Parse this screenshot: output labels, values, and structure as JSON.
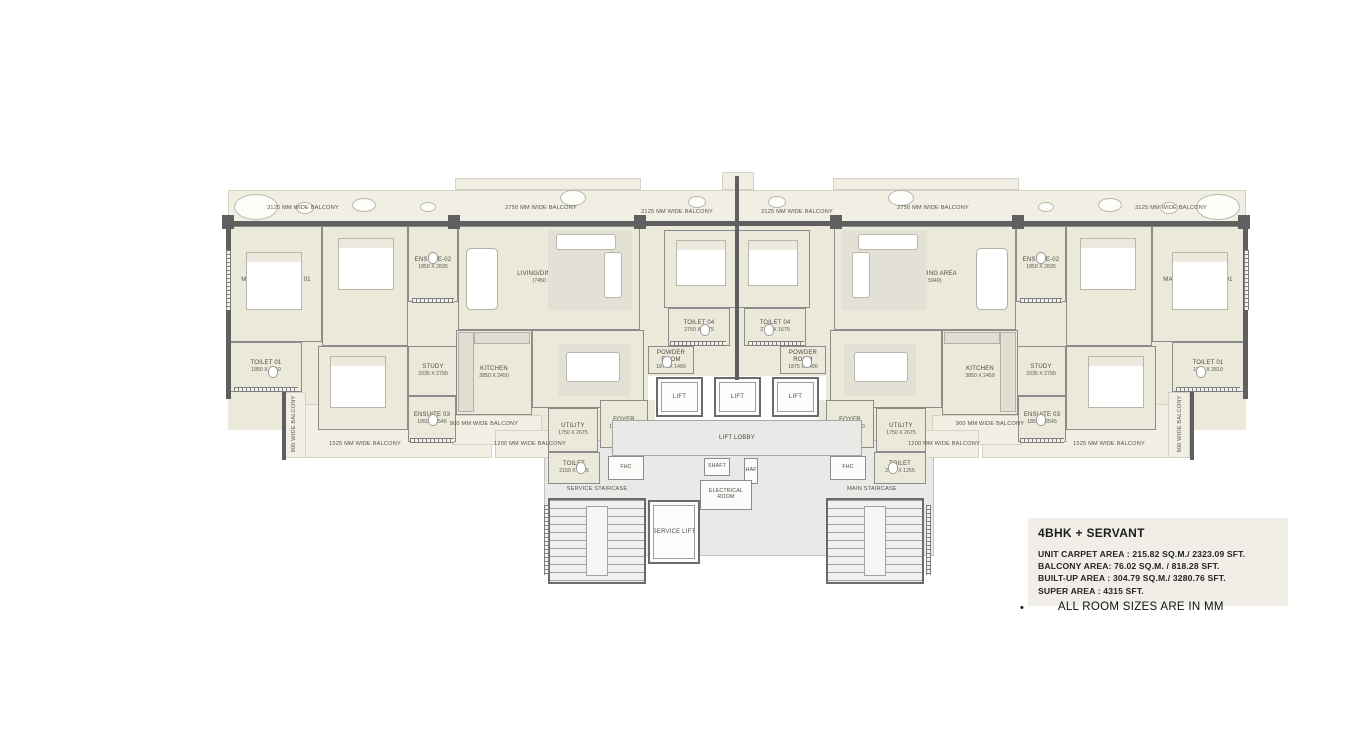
{
  "info": {
    "title": "4BHK + SERVANT",
    "lines": [
      "UNIT CARPET AREA : 215.82  SQ.M./ 2323.09  SFT.",
      "BALCONY AREA: 76.02  SQ.M. / 818.28  SFT.",
      "BUILT-UP AREA : 304.79  SQ.M./ 3280.76 SFT.",
      "SUPER AREA : 4315 SFT."
    ],
    "bullet": "•",
    "note": "ALL ROOM SIZES ARE IN MM"
  },
  "floorplan": {
    "slabs": [
      [
        "bal",
        228,
        190,
        1018,
        36
      ],
      [
        "bal",
        455,
        178,
        186,
        12
      ],
      [
        "bal",
        833,
        178,
        186,
        12
      ],
      [
        "bal",
        722,
        172,
        32,
        18
      ],
      [
        "floor",
        228,
        226,
        420,
        204
      ],
      [
        "floor",
        826,
        226,
        420,
        204
      ],
      [
        "floor",
        640,
        226,
        196,
        150
      ],
      [
        "floor",
        545,
        400,
        110,
        92
      ],
      [
        "floor",
        819,
        400,
        110,
        92
      ],
      [
        "core",
        544,
        440,
        390,
        116
      ],
      [
        "bal",
        288,
        404,
        204,
        54
      ],
      [
        "bal",
        982,
        404,
        204,
        54
      ],
      [
        "bal",
        284,
        392,
        22,
        66
      ],
      [
        "bal",
        1168,
        392,
        22,
        66
      ],
      [
        "bal",
        452,
        415,
        90,
        30
      ],
      [
        "bal",
        932,
        415,
        90,
        30
      ],
      [
        "bal",
        495,
        430,
        80,
        28
      ],
      [
        "bal",
        899,
        430,
        80,
        28
      ]
    ],
    "rooms": [
      {
        "id": "master-bedroom-01-left",
        "n": "MASTER BEDROOM 01",
        "d": "3350 X 5500",
        "x": 230,
        "y": 226,
        "w": 92,
        "h": 116
      },
      {
        "id": "toilet-01-left",
        "n": "TOILET 01",
        "d": "1850 X 2810",
        "x": 230,
        "y": 342,
        "w": 72,
        "h": 50
      },
      {
        "id": "bedroom-02-left",
        "n": "BEDROOM 02",
        "d": "3675 X 4450",
        "x": 322,
        "y": 226,
        "w": 86,
        "h": 120
      },
      {
        "id": "ensuite-02-left",
        "n": "ENSUITE-02",
        "d": "1850 X 2835",
        "x": 408,
        "y": 226,
        "w": 50,
        "h": 76
      },
      {
        "id": "living-dining-left",
        "n": "LIVING/DINING AREA",
        "d": "(7450 X 5940)",
        "x": 458,
        "y": 226,
        "w": 182,
        "h": 104
      },
      {
        "id": "bedroom-04-left",
        "n": "BEDROOM 04",
        "d": "3750 X 4335",
        "x": 664,
        "y": 230,
        "w": 73,
        "h": 78
      },
      {
        "id": "toilet-04-left",
        "n": "TOILET 04",
        "d": "2750 X 1675",
        "x": 668,
        "y": 308,
        "w": 62,
        "h": 38
      },
      {
        "id": "powder-room-left",
        "n": "POWDER ROOM",
        "d": "1875 X 1490",
        "x": 648,
        "y": 346,
        "w": 46,
        "h": 28
      },
      {
        "id": "bedroom-03-left",
        "n": "BEDROOM 03",
        "d": "3675 X 3345",
        "x": 318,
        "y": 346,
        "w": 90,
        "h": 84
      },
      {
        "id": "study-left",
        "n": "STUDY",
        "d": "2035 X 2790",
        "x": 408,
        "y": 346,
        "w": 50,
        "h": 50
      },
      {
        "id": "ensuite-03-left",
        "n": "ENSUITE 03",
        "d": "1850 X 2545",
        "x": 408,
        "y": 396,
        "w": 48,
        "h": 46
      },
      {
        "id": "kitchen-left",
        "n": "KITCHEN",
        "d": "3850 X 2450",
        "x": 456,
        "y": 330,
        "w": 76,
        "h": 85
      },
      {
        "id": "lounge-left",
        "n": "LOUNGE",
        "d": "4550 X 4725",
        "x": 532,
        "y": 330,
        "w": 112,
        "h": 78
      },
      {
        "id": "foyer-left",
        "n": "FOYER",
        "d": "1840 X 2790",
        "x": 600,
        "y": 400,
        "w": 48,
        "h": 48
      },
      {
        "id": "utility-left",
        "n": "UTILITY",
        "d": "1750 X 2675",
        "x": 548,
        "y": 408,
        "w": 50,
        "h": 44
      },
      {
        "id": "toilet-servant-left",
        "n": "TOILET",
        "d": "2150 X 1255",
        "x": 548,
        "y": 452,
        "w": 52,
        "h": 32
      },
      {
        "id": "fhc-left",
        "n": "FHC",
        "d": "",
        "x": 608,
        "y": 456,
        "w": 36,
        "h": 24,
        "k": "core"
      },
      {
        "id": "master-bedroom-01-right",
        "n": "MASTER BEDROOM 01",
        "d": "3350 X 5500",
        "x": 1152,
        "y": 226,
        "w": 92,
        "h": 116
      },
      {
        "id": "toilet-01-right",
        "n": "TOILET 01",
        "d": "1850 X 2810",
        "x": 1172,
        "y": 342,
        "w": 72,
        "h": 50
      },
      {
        "id": "bedroom-02-right",
        "n": "BEDROOM 02",
        "d": "3675 X 4450",
        "x": 1066,
        "y": 226,
        "w": 86,
        "h": 120
      },
      {
        "id": "ensuite-02-right",
        "n": "ENSUITE-02",
        "d": "1850 X 2835",
        "x": 1016,
        "y": 226,
        "w": 50,
        "h": 76
      },
      {
        "id": "living-dining-right",
        "n": "LIVING/DINING AREA",
        "d": "(7450 X 5940)",
        "x": 834,
        "y": 226,
        "w": 182,
        "h": 104
      },
      {
        "id": "bedroom-04-right",
        "n": "BEDROOM 04",
        "d": "3750 X 4335",
        "x": 737,
        "y": 230,
        "w": 73,
        "h": 78
      },
      {
        "id": "toilet-04-right",
        "n": "TOILET 04",
        "d": "2750 X 1675",
        "x": 744,
        "y": 308,
        "w": 62,
        "h": 38
      },
      {
        "id": "powder-room-right",
        "n": "POWDER ROOM",
        "d": "1875 X 1490",
        "x": 780,
        "y": 346,
        "w": 46,
        "h": 28
      },
      {
        "id": "bedroom-03-right",
        "n": "BEDROOM 03",
        "d": "3675 X 3345",
        "x": 1066,
        "y": 346,
        "w": 90,
        "h": 84
      },
      {
        "id": "study-right",
        "n": "STUDY",
        "d": "2035 X 2790",
        "x": 1016,
        "y": 346,
        "w": 50,
        "h": 50
      },
      {
        "id": "ensuite-03-right",
        "n": "ENSUITE 03",
        "d": "1850 X 2545",
        "x": 1018,
        "y": 396,
        "w": 48,
        "h": 46
      },
      {
        "id": "kitchen-right",
        "n": "KITCHEN",
        "d": "3850 X 2450",
        "x": 942,
        "y": 330,
        "w": 76,
        "h": 85
      },
      {
        "id": "lounge-right",
        "n": "LOUNGE",
        "d": "4550 X 4725",
        "x": 830,
        "y": 330,
        "w": 112,
        "h": 78
      },
      {
        "id": "foyer-right",
        "n": "FOYER",
        "d": "1840 X 2790",
        "x": 826,
        "y": 400,
        "w": 48,
        "h": 48
      },
      {
        "id": "utility-right",
        "n": "UTILITY",
        "d": "1750 X 2675",
        "x": 876,
        "y": 408,
        "w": 50,
        "h": 44
      },
      {
        "id": "toilet-servant-right",
        "n": "TOILET",
        "d": "2150 X 1255",
        "x": 874,
        "y": 452,
        "w": 52,
        "h": 32
      },
      {
        "id": "fhc-right",
        "n": "FHC",
        "d": "",
        "x": 830,
        "y": 456,
        "w": 36,
        "h": 24,
        "k": "core"
      },
      {
        "id": "lift-1",
        "n": "LIFT",
        "d": "",
        "x": 656,
        "y": 377,
        "w": 47,
        "h": 40,
        "k": "lift"
      },
      {
        "id": "lift-2",
        "n": "LIFT",
        "d": "",
        "x": 714,
        "y": 377,
        "w": 47,
        "h": 40,
        "k": "lift"
      },
      {
        "id": "lift-3",
        "n": "LIFT",
        "d": "",
        "x": 772,
        "y": 377,
        "w": 47,
        "h": 40,
        "k": "lift"
      },
      {
        "id": "lift-lobby",
        "n": "LIFT LOBBY",
        "d": "",
        "x": 612,
        "y": 420,
        "w": 250,
        "h": 36,
        "k": "lobby"
      },
      {
        "id": "shaft-1",
        "n": "SHAFT",
        "d": "",
        "x": 704,
        "y": 458,
        "w": 26,
        "h": 18,
        "k": "core"
      },
      {
        "id": "shaft-2",
        "n": "SHAFT",
        "d": "",
        "x": 744,
        "y": 458,
        "w": 14,
        "h": 26,
        "k": "core"
      },
      {
        "id": "electrical-room",
        "n": "ELECTRICAL ROOM",
        "d": "",
        "x": 700,
        "y": 480,
        "w": 52,
        "h": 30,
        "k": "core"
      },
      {
        "id": "service-lift",
        "n": "SERVICE LIFT",
        "d": "",
        "x": 648,
        "y": 500,
        "w": 52,
        "h": 64,
        "k": "lift"
      },
      {
        "id": "service-staircase",
        "n": "",
        "d": "",
        "x": 548,
        "y": 498,
        "w": 98,
        "h": 86,
        "k": "stair"
      },
      {
        "id": "main-staircase",
        "n": "",
        "d": "",
        "x": 826,
        "y": 498,
        "w": 98,
        "h": 86,
        "k": "stair"
      }
    ],
    "walls": [
      [
        226,
        221,
        1022,
        5
      ],
      [
        226,
        221,
        5,
        178
      ],
      [
        1243,
        221,
        5,
        178
      ],
      [
        735,
        176,
        4,
        204
      ],
      [
        222,
        215,
        12,
        14
      ],
      [
        448,
        215,
        12,
        14
      ],
      [
        634,
        215,
        12,
        14
      ],
      [
        830,
        215,
        12,
        14
      ],
      [
        1012,
        215,
        12,
        14
      ],
      [
        1238,
        215,
        12,
        14
      ],
      [
        282,
        390,
        4,
        70
      ],
      [
        1190,
        390,
        4,
        70
      ]
    ],
    "windows": [
      [
        "v",
        226,
        250,
        5,
        60
      ],
      [
        "v",
        1244,
        250,
        5,
        60
      ],
      [
        "h",
        412,
        298,
        42,
        5
      ],
      [
        "h",
        1020,
        298,
        42,
        5
      ],
      [
        "h",
        670,
        341,
        56,
        5
      ],
      [
        "h",
        748,
        341,
        56,
        5
      ],
      [
        "h",
        234,
        387,
        64,
        5
      ],
      [
        "h",
        1176,
        387,
        64,
        5
      ],
      [
        "h",
        410,
        438,
        44,
        5
      ],
      [
        "h",
        1020,
        438,
        44,
        5
      ],
      [
        "v",
        544,
        505,
        5,
        70
      ],
      [
        "v",
        926,
        505,
        5,
        70
      ]
    ],
    "furniture": [
      [
        "bed",
        246,
        252,
        56,
        58
      ],
      [
        "bed",
        1172,
        252,
        56,
        58
      ],
      [
        "bed",
        338,
        238,
        56,
        52
      ],
      [
        "bed",
        1080,
        238,
        56,
        52
      ],
      [
        "bed",
        676,
        240,
        50,
        46
      ],
      [
        "bed",
        748,
        240,
        50,
        46
      ],
      [
        "bed",
        330,
        356,
        56,
        52
      ],
      [
        "bed",
        1088,
        356,
        56,
        52
      ],
      [
        "rug",
        548,
        230,
        84,
        80
      ],
      [
        "rug",
        842,
        230,
        84,
        80
      ],
      [
        "sofa",
        556,
        234,
        60,
        16
      ],
      [
        "sofa",
        858,
        234,
        60,
        16
      ],
      [
        "sofa",
        604,
        252,
        18,
        46
      ],
      [
        "sofa",
        852,
        252,
        18,
        46
      ],
      [
        "table",
        466,
        248,
        32,
        62
      ],
      [
        "table",
        976,
        248,
        32,
        62
      ],
      [
        "rug",
        558,
        344,
        72,
        52
      ],
      [
        "rug",
        844,
        344,
        72,
        52
      ],
      [
        "sofa",
        566,
        352,
        54,
        30
      ],
      [
        "sofa",
        854,
        352,
        54,
        30
      ],
      [
        "counter",
        458,
        332,
        16,
        80
      ],
      [
        "counter",
        1000,
        332,
        16,
        80
      ],
      [
        "counter",
        474,
        332,
        56,
        12
      ],
      [
        "counter",
        944,
        332,
        56,
        12
      ],
      [
        "landing",
        586,
        506,
        22,
        70
      ],
      [
        "landing",
        864,
        506,
        22,
        70
      ],
      [
        "plant",
        234,
        194,
        44,
        26
      ],
      [
        "plant",
        1196,
        194,
        44,
        26
      ],
      [
        "plant",
        296,
        202,
        18,
        12
      ],
      [
        "plant",
        1160,
        202,
        18,
        12
      ],
      [
        "plant",
        352,
        198,
        24,
        14
      ],
      [
        "plant",
        1098,
        198,
        24,
        14
      ],
      [
        "plant",
        420,
        202,
        16,
        10
      ],
      [
        "plant",
        1038,
        202,
        16,
        10
      ],
      [
        "plant",
        560,
        190,
        26,
        16
      ],
      [
        "plant",
        888,
        190,
        26,
        16
      ],
      [
        "plant",
        688,
        196,
        18,
        12
      ],
      [
        "plant",
        768,
        196,
        18,
        12
      ],
      [
        "wc",
        268,
        366,
        10,
        12
      ],
      [
        "wc",
        1196,
        366,
        10,
        12
      ],
      [
        "wc",
        428,
        252,
        10,
        12
      ],
      [
        "wc",
        1036,
        252,
        10,
        12
      ],
      [
        "wc",
        700,
        324,
        10,
        12
      ],
      [
        "wc",
        764,
        324,
        10,
        12
      ],
      [
        "wc",
        662,
        356,
        10,
        12
      ],
      [
        "wc",
        802,
        356,
        10,
        12
      ],
      [
        "wc",
        428,
        414,
        10,
        12
      ],
      [
        "wc",
        1036,
        414,
        10,
        12
      ],
      [
        "wc",
        576,
        462,
        10,
        12
      ],
      [
        "wc",
        888,
        462,
        10,
        12
      ]
    ],
    "labels": [
      [
        "3125 MM WIDE BALCONY",
        303,
        208,
        ""
      ],
      [
        "2750 MM WIDE BALCONY",
        541,
        208,
        ""
      ],
      [
        "2125 MM WIDE BALCONY",
        677,
        212,
        ""
      ],
      [
        "2125 MM WIDE BALCONY",
        797,
        212,
        ""
      ],
      [
        "2750 MM WIDE BALCONY",
        933,
        208,
        ""
      ],
      [
        "3125 MM WIDE BALCONY",
        1171,
        208,
        ""
      ],
      [
        "1525 MM WIDE BALCONY",
        365,
        444,
        ""
      ],
      [
        "1525 MM WIDE BALCONY",
        1109,
        444,
        ""
      ],
      [
        "900 MM WIDE BALCONY",
        484,
        424,
        ""
      ],
      [
        "900 MM WIDE BALCONY",
        990,
        424,
        ""
      ],
      [
        "1200 MM WIDE BALCONY",
        530,
        444,
        ""
      ],
      [
        "1200 MM WIDE BALCONY",
        944,
        444,
        ""
      ],
      [
        "900 WIDE BALCONY",
        294,
        424,
        "v"
      ],
      [
        "900 WIDE BALCONY",
        1180,
        424,
        "v"
      ],
      [
        "SERVICE STAIRCASE",
        597,
        489,
        ""
      ],
      [
        "MAIN STAIRCASE",
        872,
        489,
        ""
      ]
    ]
  }
}
